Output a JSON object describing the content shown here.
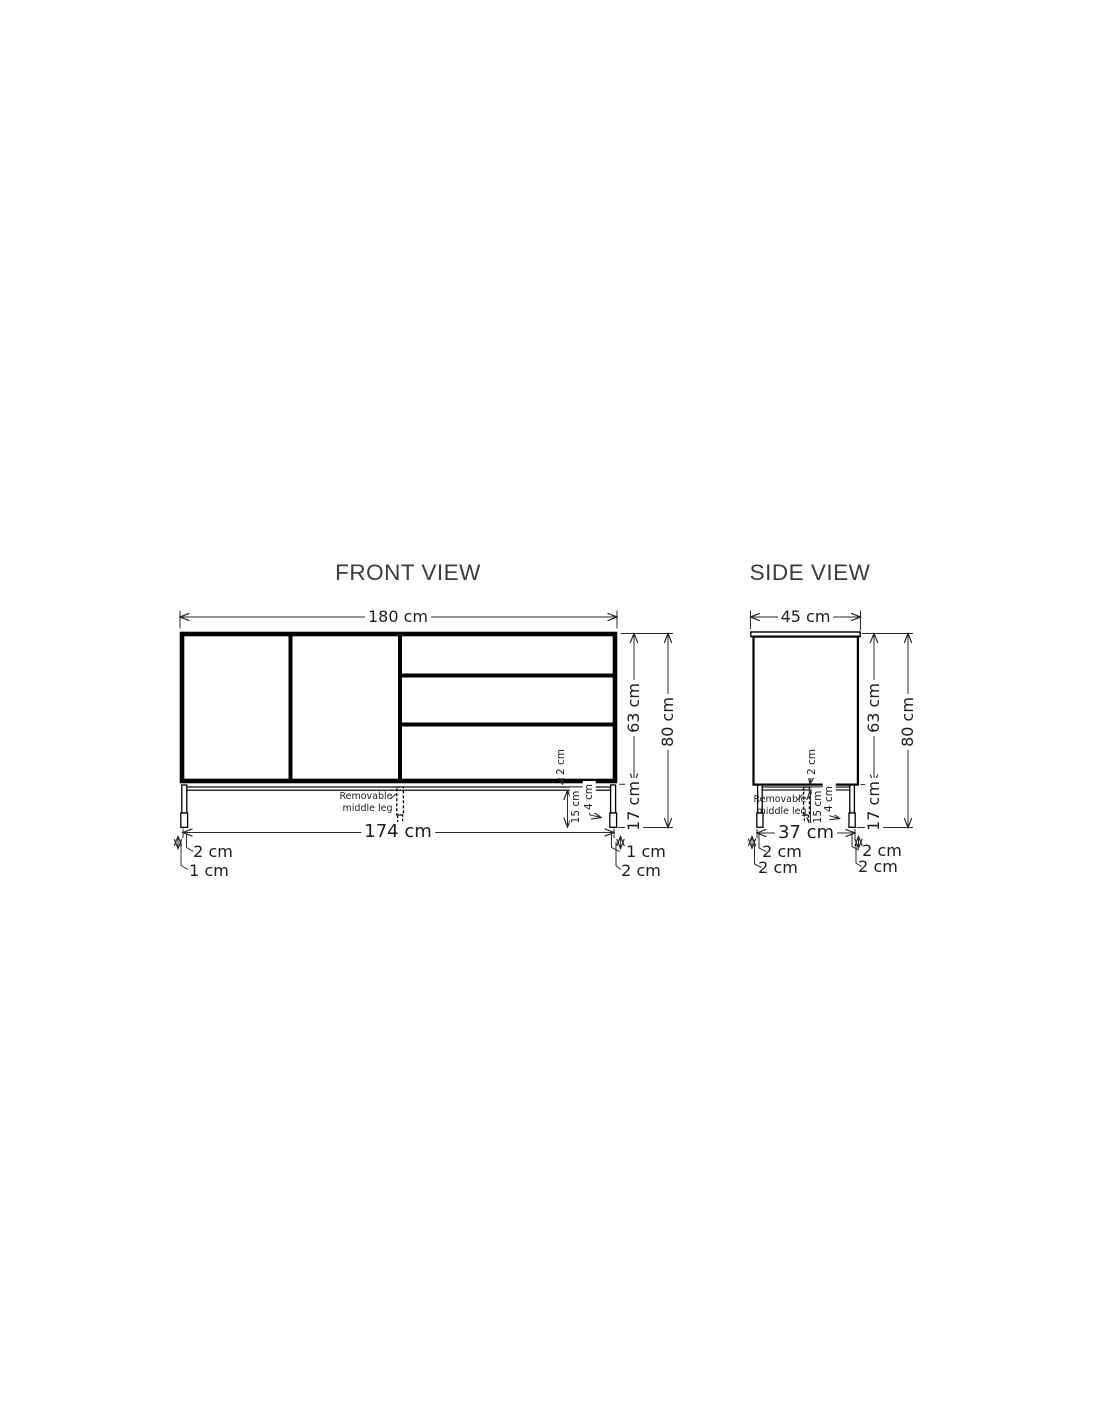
{
  "drawing": {
    "background": "#ffffff",
    "line_color": "#000000",
    "dimension_line_color": "#2a2a2a",
    "text_color": "#1c1c1c",
    "title_color": "#3b3b3b"
  },
  "front_view": {
    "title": "FRONT VIEW",
    "overall_width": "180 cm",
    "body_height": "63 cm",
    "total_height": "80 cm",
    "leg_height": "17 cm",
    "leg_span_width": "174 cm",
    "bottom_panel_thickness": "2 cm",
    "leg_below_frame": "15 cm",
    "foot_height": "4 cm",
    "bottom_left_outer": "2 cm",
    "bottom_left_inner": "1 cm",
    "bottom_right_inner": "1 cm",
    "bottom_right_outer": "2 cm",
    "middle_leg_note": "Removable\nmiddle leg"
  },
  "side_view": {
    "title": "SIDE VIEW",
    "overall_depth": "45 cm",
    "body_height": "63 cm",
    "total_height": "80 cm",
    "leg_height": "17 cm",
    "leg_span_depth": "37 cm",
    "bottom_panel_thickness": "2 cm",
    "leg_below_frame": "15 cm",
    "foot_height": "4 cm",
    "bottom_left_outer": "2 cm",
    "bottom_left_inner": "2 cm",
    "bottom_right_inner": "2 cm",
    "bottom_right_outer": "2 cm",
    "middle_leg_note": "Removable\nmiddle leg"
  }
}
